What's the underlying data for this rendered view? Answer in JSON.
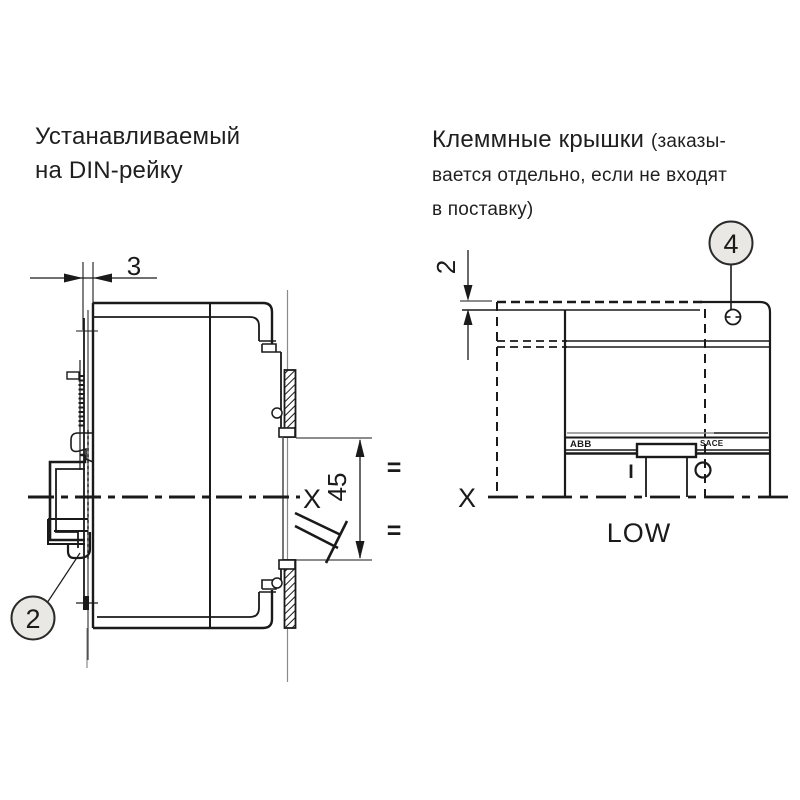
{
  "colors": {
    "line": "#1a1a1a",
    "callout_fill": "#e9e8e4",
    "gray_line": "#8a8a8a"
  },
  "left_diagram": {
    "title_line1": "Устанавливаемый",
    "title_line2": "на DIN-рейку",
    "dim_rail_offset": "3",
    "dim_handle_travel": "45",
    "axis_label": "X",
    "equal_top": "=",
    "equal_bottom": "=",
    "callout_number": "2"
  },
  "right_diagram": {
    "title_main": "Клеммные крышки",
    "title_note_line1": "(заказы-",
    "title_note_line2": "вается отдельно, если не входят",
    "title_note_line3": "в поставку)",
    "dim_cover_thickness": "2",
    "callout_number": "4",
    "axis_label": "X",
    "size_label": "LOW",
    "brand_label": "ABB",
    "series_label": "SACE",
    "switch_on_label": "I"
  }
}
